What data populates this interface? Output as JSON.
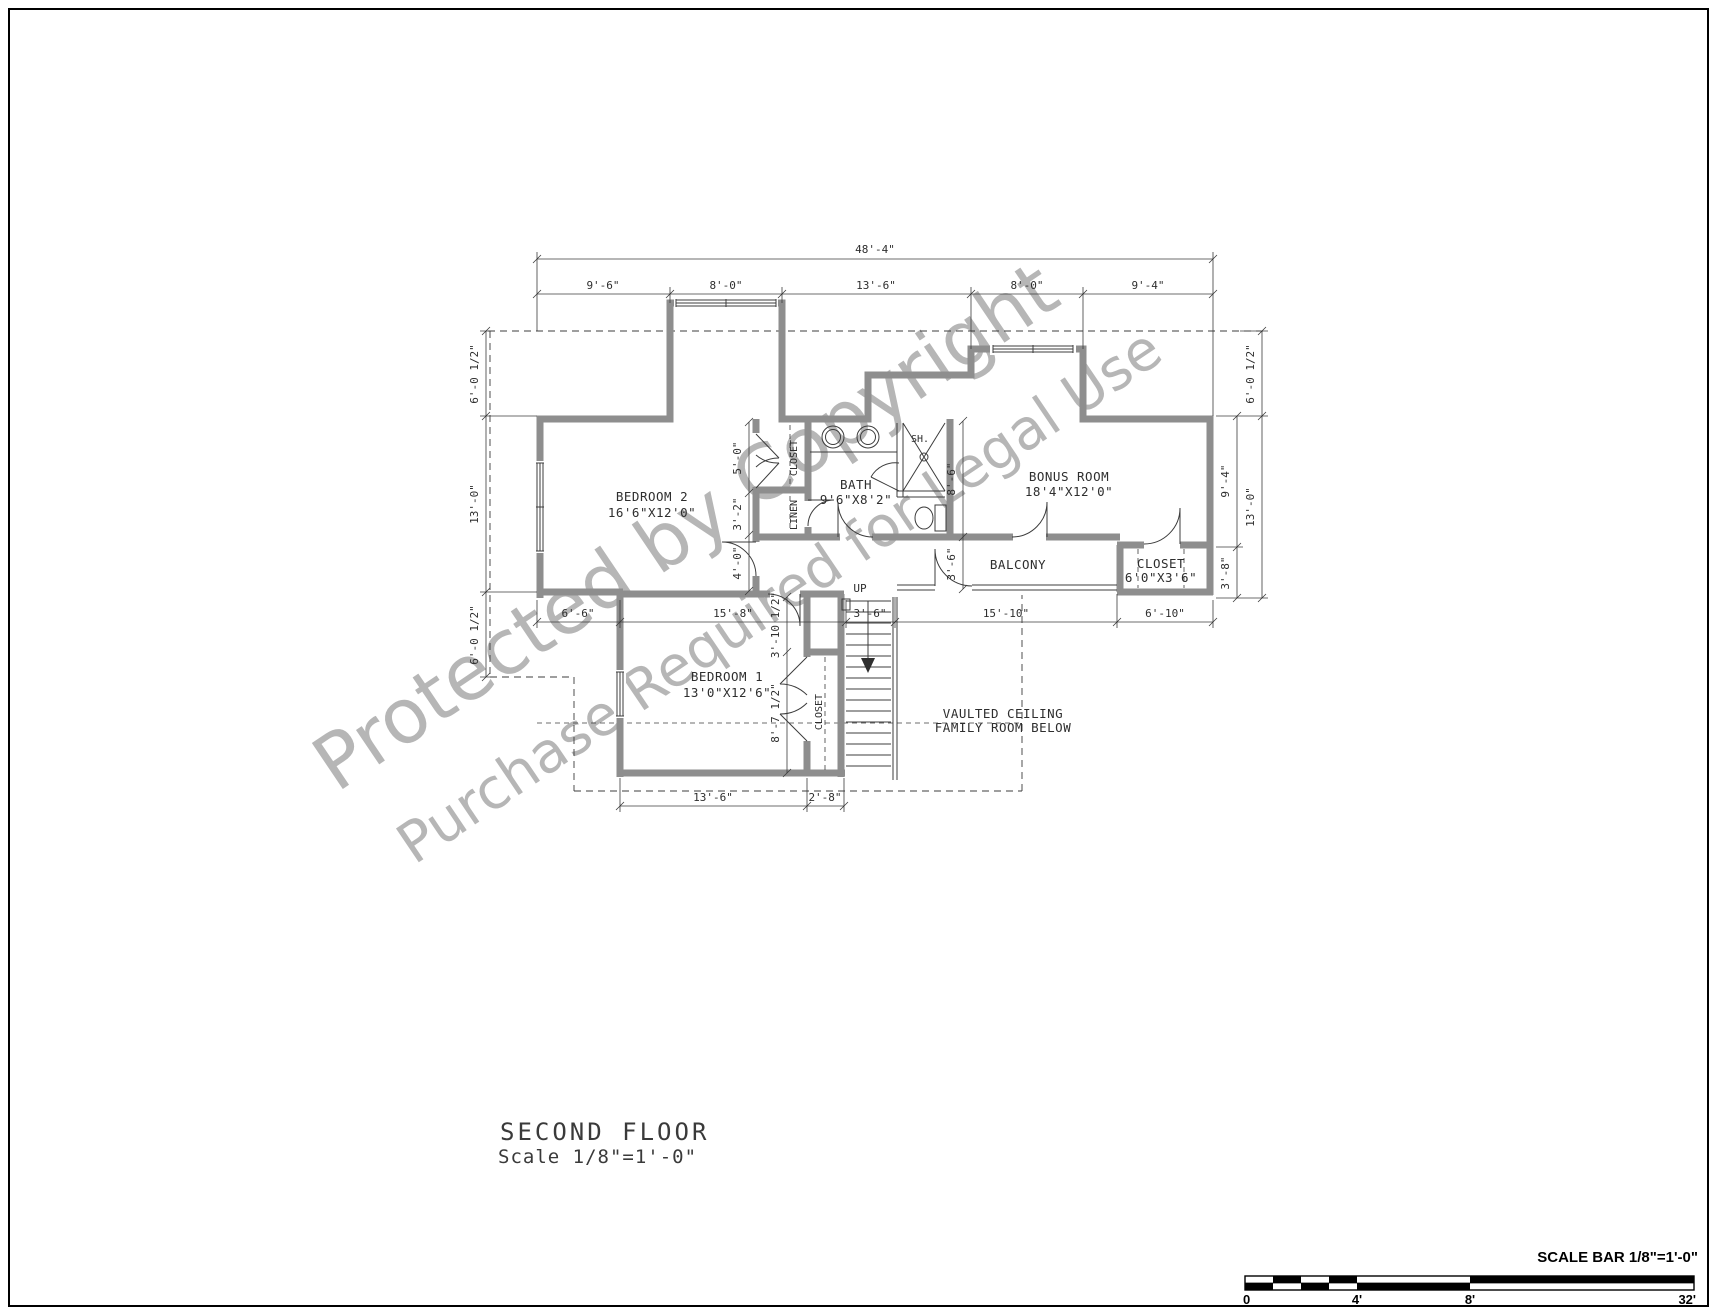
{
  "watermark": {
    "line1": "Protected by Copyright",
    "line2": "Purchase Required for Legal Use"
  },
  "title": {
    "name": "SECOND FLOOR",
    "scale": "Scale 1/8\"=1'-0\""
  },
  "scale_bar": {
    "label": "SCALE BAR 1/8\"=1'-0\"",
    "ticks": [
      "0",
      "4'",
      "8'",
      "32'"
    ]
  },
  "rooms": {
    "bedroom2": {
      "name": "BEDROOM 2",
      "size": "16'6\"X12'0\""
    },
    "bedroom1": {
      "name": "BEDROOM 1",
      "size": "13'0\"X12'6\""
    },
    "bath": {
      "name": "BATH",
      "size": "9'6\"X8'2\""
    },
    "bonus": {
      "name": "BONUS ROOM",
      "size": "18'4\"X12'0\""
    },
    "balcony": {
      "name": "BALCONY"
    },
    "closet_bonus": {
      "name": "CLOSET",
      "size": "6'0\"X3'6\""
    },
    "closet_bed2": {
      "name": "CLOSET"
    },
    "closet_bed1": {
      "name": "CLOSET"
    },
    "linen": {
      "name": "LINEN"
    },
    "shower": {
      "name": "SH."
    },
    "stairs": {
      "name": "UP"
    },
    "note": {
      "line1": "VAULTED CEILING",
      "line2": "FAMILY ROOM BELOW"
    }
  },
  "dims": {
    "top_overall": "48'-4\"",
    "top": [
      "9'-6\"",
      "8'-0\"",
      "13'-6\"",
      "8'-0\"",
      "9'-4\""
    ],
    "left": [
      "6'-0 1/2\"",
      "13'-0\"",
      "6'-0 1/2\""
    ],
    "right_upper": "6'-0 1/2\"",
    "right_inner": [
      "9'-4\"",
      "3'-8\""
    ],
    "right_outer": "13'-0\"",
    "hall": [
      "5'-0\"",
      "3'-2\"",
      "4'-0\""
    ],
    "bath_side": [
      "8'-6\"",
      "3'-6\""
    ],
    "bed1_side": [
      "3'-10 1/2\"",
      "8'-7 1/2\""
    ],
    "bottom": [
      "6'-6\"",
      "15'-8\"",
      "3'-6\"",
      "15'-10\"",
      "6'-10\""
    ],
    "bottom2": [
      "13'-6\"",
      "2'-8\""
    ]
  }
}
